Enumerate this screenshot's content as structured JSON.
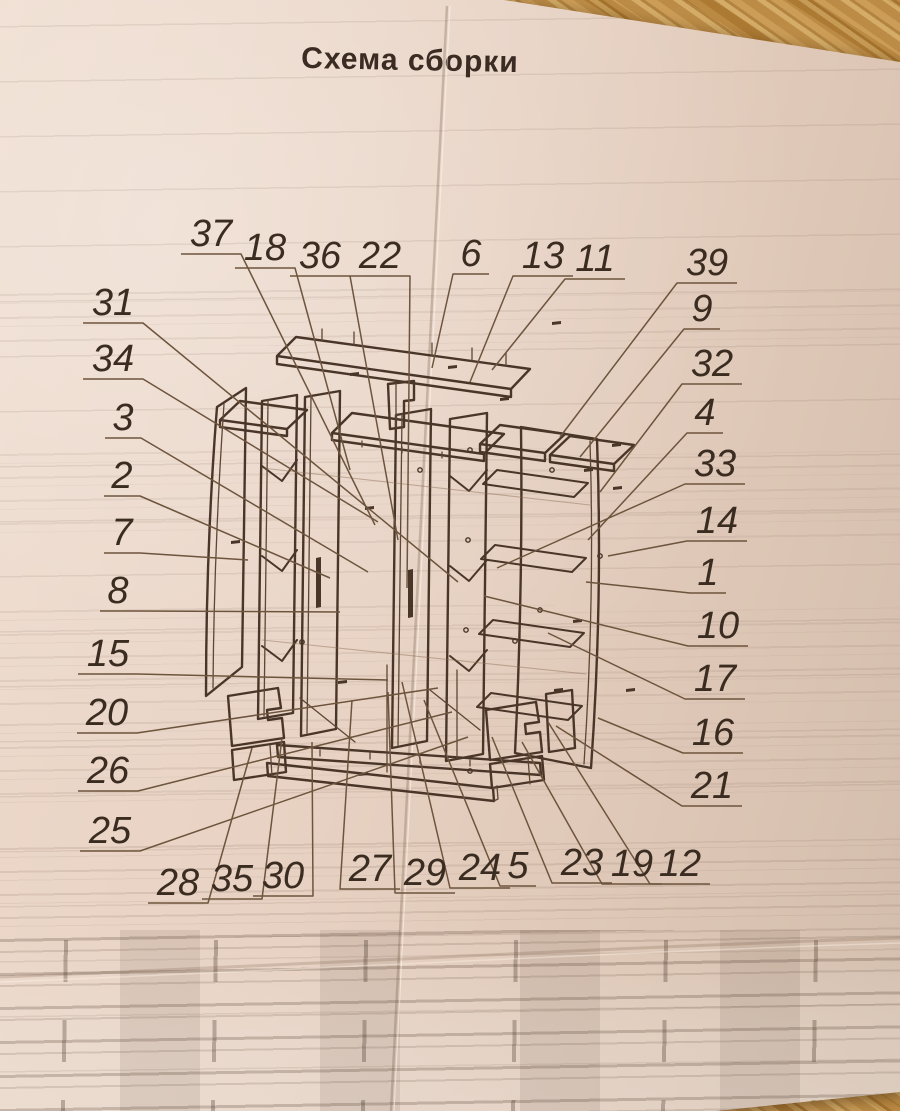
{
  "title": "Схема сборки",
  "colors": {
    "ink": "#4a3628",
    "label": "#3b2c21",
    "paper": "#e7d1c2",
    "wood": "#b8863b"
  },
  "diagram": {
    "type": "exploded-assembly-drawing",
    "subject": "wardrobe cabinet",
    "labels": [
      {
        "n": "37",
        "x": 211,
        "y": 233,
        "tx": 375,
        "ty": 525
      },
      {
        "n": "18",
        "x": 265,
        "y": 247,
        "tx": 350,
        "ty": 470
      },
      {
        "n": "36",
        "x": 320,
        "y": 255,
        "tx": 398,
        "ty": 540
      },
      {
        "n": "22",
        "x": 380,
        "y": 255,
        "tx": 407,
        "ty": 588
      },
      {
        "n": "6",
        "x": 471,
        "y": 253,
        "tx": 432,
        "ty": 368
      },
      {
        "n": "13",
        "x": 543,
        "y": 255,
        "tx": 470,
        "ty": 382
      },
      {
        "n": "11",
        "x": 595,
        "y": 258,
        "tx": 492,
        "ty": 370
      },
      {
        "n": "39",
        "x": 707,
        "y": 262,
        "tx": 560,
        "ty": 437
      },
      {
        "n": "9",
        "x": 702,
        "y": 308,
        "tx": 580,
        "ty": 457
      },
      {
        "n": "32",
        "x": 712,
        "y": 363,
        "tx": 600,
        "ty": 492
      },
      {
        "n": "4",
        "x": 705,
        "y": 412,
        "tx": 588,
        "ty": 540
      },
      {
        "n": "33",
        "x": 715,
        "y": 463,
        "tx": 497,
        "ty": 568
      },
      {
        "n": "14",
        "x": 717,
        "y": 520,
        "tx": 608,
        "ty": 556
      },
      {
        "n": "1",
        "x": 708,
        "y": 572,
        "tx": 586,
        "ty": 582
      },
      {
        "n": "10",
        "x": 718,
        "y": 625,
        "tx": 484,
        "ty": 596
      },
      {
        "n": "17",
        "x": 715,
        "y": 678,
        "tx": 548,
        "ty": 633
      },
      {
        "n": "16",
        "x": 713,
        "y": 732,
        "tx": 598,
        "ty": 718
      },
      {
        "n": "21",
        "x": 712,
        "y": 785,
        "tx": 556,
        "ty": 726
      },
      {
        "n": "31",
        "x": 113,
        "y": 302,
        "tx": 458,
        "ty": 582
      },
      {
        "n": "34",
        "x": 113,
        "y": 358,
        "tx": 378,
        "ty": 522
      },
      {
        "n": "3",
        "x": 123,
        "y": 417,
        "tx": 368,
        "ty": 572
      },
      {
        "n": "2",
        "x": 122,
        "y": 475,
        "tx": 330,
        "ty": 578
      },
      {
        "n": "7",
        "x": 122,
        "y": 532,
        "tx": 248,
        "ty": 560
      },
      {
        "n": "8",
        "x": 118,
        "y": 590,
        "tx": 340,
        "ty": 612
      },
      {
        "n": "15",
        "x": 108,
        "y": 653,
        "tx": 388,
        "ty": 680
      },
      {
        "n": "20",
        "x": 107,
        "y": 712,
        "tx": 438,
        "ty": 688
      },
      {
        "n": "26",
        "x": 108,
        "y": 770,
        "tx": 452,
        "ty": 712
      },
      {
        "n": "25",
        "x": 110,
        "y": 830,
        "tx": 468,
        "ty": 737
      },
      {
        "n": "28",
        "x": 178,
        "y": 882,
        "tx": 252,
        "ty": 748
      },
      {
        "n": "35",
        "x": 232,
        "y": 878,
        "tx": 282,
        "ty": 738
      },
      {
        "n": "30",
        "x": 283,
        "y": 875,
        "tx": 312,
        "ty": 742
      },
      {
        "n": "27",
        "x": 370,
        "y": 868,
        "tx": 352,
        "ty": 700
      },
      {
        "n": "29",
        "x": 425,
        "y": 872,
        "tx": 388,
        "ty": 692
      },
      {
        "n": "24",
        "x": 480,
        "y": 867,
        "tx": 402,
        "ty": 682
      },
      {
        "n": "5",
        "x": 518,
        "y": 865,
        "tx": 424,
        "ty": 700
      },
      {
        "n": "23",
        "x": 582,
        "y": 862,
        "tx": 492,
        "ty": 737
      },
      {
        "n": "19",
        "x": 632,
        "y": 863,
        "tx": 522,
        "ty": 742
      },
      {
        "n": "12",
        "x": 680,
        "y": 863,
        "tx": 548,
        "ty": 722
      }
    ]
  }
}
